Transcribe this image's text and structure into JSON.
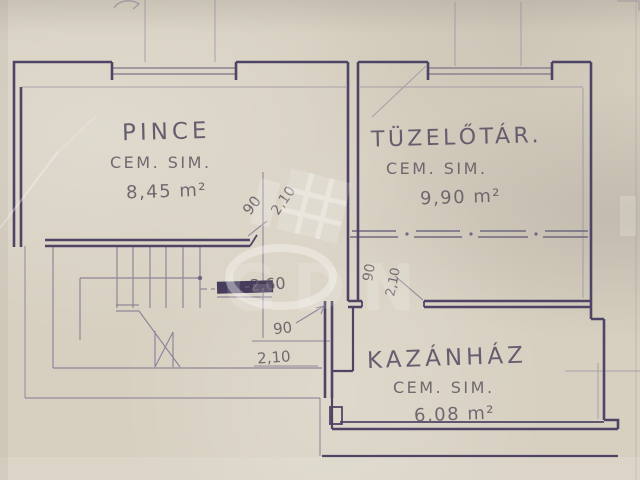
{
  "plan": {
    "rooms": [
      {
        "name": "PINCE",
        "finish": "CEM. SIM.",
        "area": "8,45 m²"
      },
      {
        "name": "TÜZELŐTÁR.",
        "finish": "CEM. SIM.",
        "area": "9,90 m²"
      },
      {
        "name": "KAZÁNHÁZ",
        "finish": "CEM. SIM.",
        "area": "6,08 m²"
      }
    ],
    "dimensions": {
      "pince_door_width": "90",
      "pince_door_height": "2,10",
      "tuzelotar_door_width": "90",
      "tuzelotar_door_height": "2,10",
      "kazanhaz_door_width": "90",
      "kazanhaz_door_height": "2,10",
      "floor_level": "-2,60"
    },
    "colors": {
      "paper": "#d7d0c1",
      "ink": "#4e4566",
      "pencil": "#8e8799",
      "handwriting": "#675f68"
    }
  }
}
